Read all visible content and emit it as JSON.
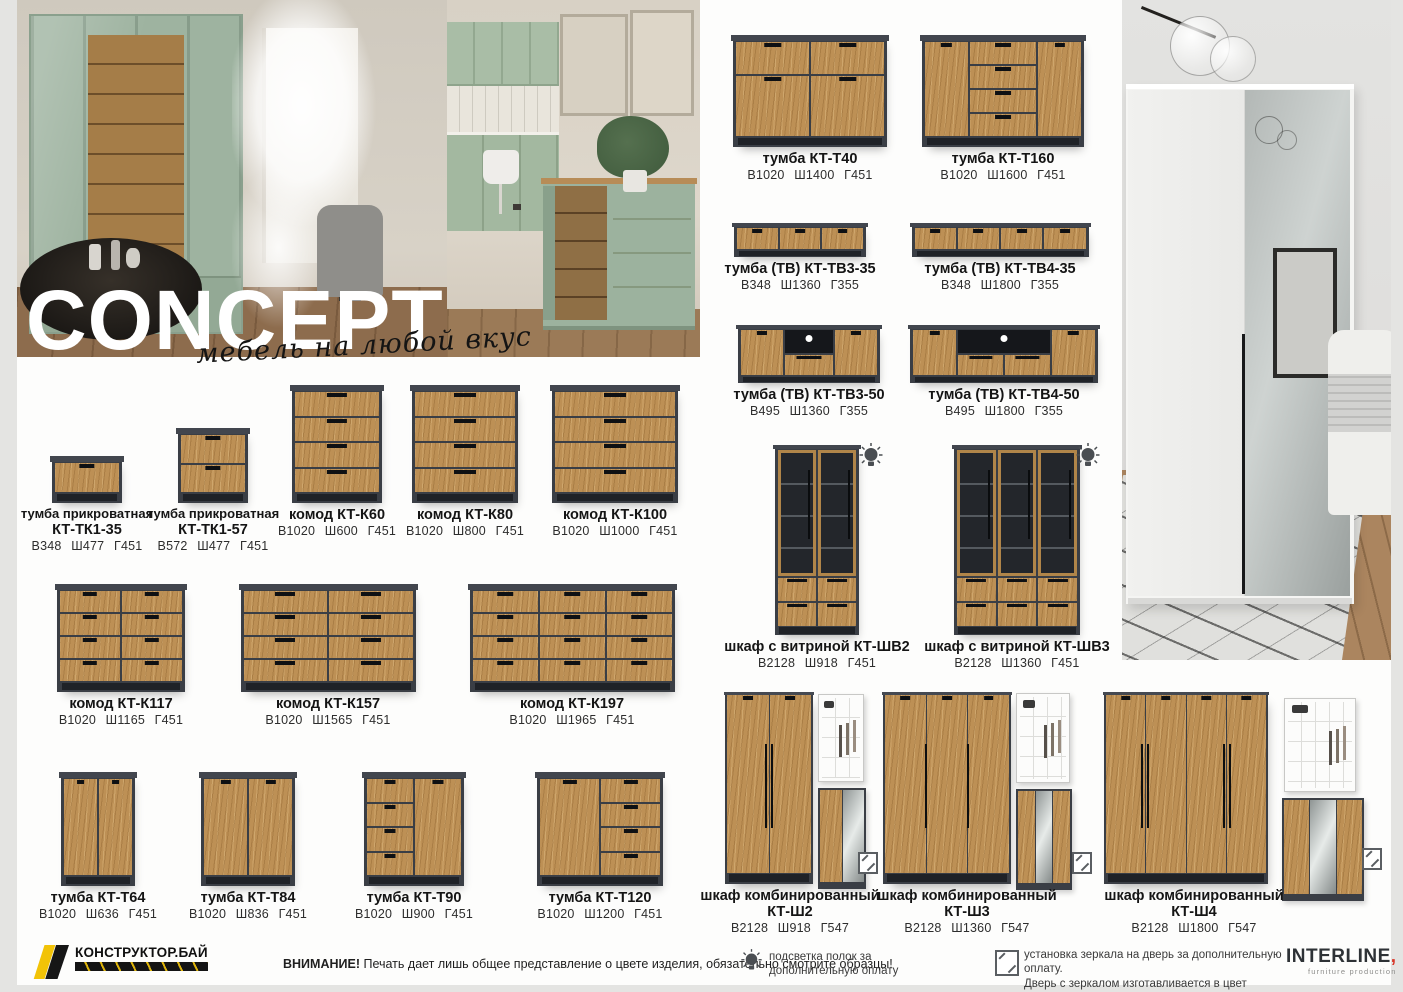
{
  "header": {
    "title": "CONCEPT",
    "subtitle": "мебель на любой вкус"
  },
  "products": {
    "tk135": {
      "line1": "тумба прикроватная",
      "line2": "КТ-ТК1-35",
      "dims": "В348 Ш477 Г451"
    },
    "tk157": {
      "line1": "тумба прикроватная",
      "line2": "КТ-ТК1-57",
      "dims": "В572 Ш477 Г451"
    },
    "k60": {
      "line1": "комод КТ-К60",
      "dims": "В1020 Ш600 Г451"
    },
    "k80": {
      "line1": "комод КТ-К80",
      "dims": "В1020 Ш800 Г451"
    },
    "k100": {
      "line1": "комод КТ-К100",
      "dims": "В1020 Ш1000 Г451"
    },
    "k117": {
      "line1": "комод КТ-К117",
      "dims": "В1020 Ш1165 Г451"
    },
    "k157": {
      "line1": "комод КТ-К157",
      "dims": "В1020 Ш1565 Г451"
    },
    "k197": {
      "line1": "комод КТ-К197",
      "dims": "В1020 Ш1965 Г451"
    },
    "t64": {
      "line1": "тумба КТ-Т64",
      "dims": "В1020 Ш636 Г451"
    },
    "t84": {
      "line1": "тумба КТ-Т84",
      "dims": "В1020 Ш836 Г451"
    },
    "t90": {
      "line1": "тумба КТ-Т90",
      "dims": "В1020 Ш900 Г451"
    },
    "t120": {
      "line1": "тумба КТ-Т120",
      "dims": "В1020 Ш1200 Г451"
    },
    "t40": {
      "line1": "тумба КТ-Т40",
      "dims": "В1020 Ш1400 Г451"
    },
    "t160": {
      "line1": "тумба КТ-Т160",
      "dims": "В1020 Ш1600 Г451"
    },
    "tv335": {
      "line1": "тумба (ТВ) КТ-ТВ3-35",
      "dims": "В348 Ш1360 Г355"
    },
    "tv435": {
      "line1": "тумба (ТВ) КТ-ТВ4-35",
      "dims": "В348 Ш1800 Г355"
    },
    "tv350": {
      "line1": "тумба (ТВ) КТ-ТВ3-50",
      "dims": "В495 Ш1360 Г355"
    },
    "tv450": {
      "line1": "тумба (ТВ) КТ-ТВ4-50",
      "dims": "В495 Ш1800 Г355"
    },
    "shv2": {
      "line1": "шкаф с витриной КТ-ШВ2",
      "dims": "В2128 Ш918 Г451"
    },
    "shv3": {
      "line1": "шкаф с витриной КТ-ШВ3",
      "dims": "В2128 Ш1360 Г451"
    },
    "sh2": {
      "line1": "шкаф комбинированный",
      "line2": "КТ-Ш2",
      "dims": "В2128 Ш918 Г547"
    },
    "sh3": {
      "line1": "шкаф комбинированный",
      "line2": "КТ-Ш3",
      "dims": "В2128 Ш1360 Г547"
    },
    "sh4": {
      "line1": "шкаф комбинированный",
      "line2": "КТ-Ш4",
      "dims": "В2128 Ш1800 Г547"
    }
  },
  "footer": {
    "warning_bold": "ВНИМАНИЕ!",
    "warning_text": " Печать дает лишь общее представление о цвете изделия, обязательно смотрите образцы!",
    "legend_bulb": "подсветка полок за дополнительную оплату",
    "legend_mirror_line1": "установка зеркала на дверь за дополнительную оплату.",
    "legend_mirror_line2": "Дверь с зеркалом изготавливается в цвет корпуса.",
    "logo_left": {
      "name": "КОНСТРУКТОР.БАЙ"
    },
    "logo_right": {
      "name": "INTERLINE",
      "mark": ",",
      "tagline": "furniture production"
    }
  },
  "colors": {
    "wood": "#bd9055",
    "frame_dark": "#3a3e45",
    "logo_yellow": "#f2c307",
    "accent_red": "#d8372a",
    "page_bg": "#e4e4e2"
  }
}
